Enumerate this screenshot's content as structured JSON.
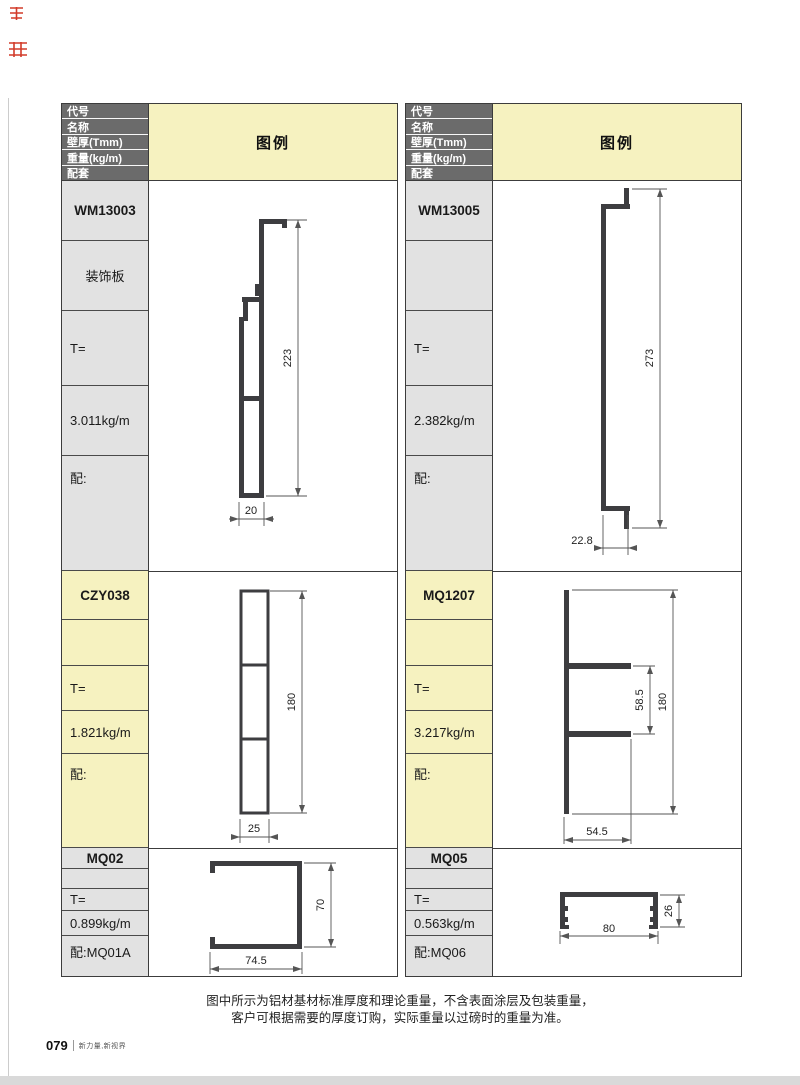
{
  "page": {
    "note_line1": "图中所示为铝材基材标准厚度和理论重量，不含表面涂层及包装重量，",
    "note_line2": "客户可根据需要的厚度订购，实际重量以过磅时的重量为准。",
    "footer_page": "079",
    "footer_brand": "新力量,新视界"
  },
  "header": {
    "rows": [
      "代号",
      "名称",
      "壁厚(Tmm)",
      "重量(kg/m)",
      "配套"
    ],
    "legend": "图例"
  },
  "colors": {
    "header_bg": "#6b6b6b",
    "yellow": "#f6f2c0",
    "gray": "#e2e2e2",
    "profile": "#3d3d40",
    "mark_red": "#d23b2a"
  },
  "left_table": {
    "sections": [
      {
        "code": "WM13003",
        "name": "装饰板",
        "thickness": "T=",
        "weight": "3.011kg/m",
        "match": "配:",
        "dims": {
          "height": "223",
          "width": "20"
        }
      },
      {
        "code": "CZY038",
        "name": "",
        "thickness": "T=",
        "weight": "1.821kg/m",
        "match": "配:",
        "dims": {
          "height": "180",
          "width": "25"
        }
      },
      {
        "code": "MQ02",
        "name": "",
        "thickness": "T=",
        "weight": "0.899kg/m",
        "match": "配:MQ01A",
        "dims": {
          "height": "70",
          "width": "74.5"
        }
      }
    ]
  },
  "right_table": {
    "sections": [
      {
        "code": "WM13005",
        "name": "",
        "thickness": "T=",
        "weight": "2.382kg/m",
        "match": "配:",
        "dims": {
          "height": "273",
          "width": "22.8"
        }
      },
      {
        "code": "MQ1207",
        "name": "",
        "thickness": "T=",
        "weight": "3.217kg/m",
        "match": "配:",
        "dims": {
          "height": "180",
          "width": "54.5",
          "inner": "58.5"
        }
      },
      {
        "code": "MQ05",
        "name": "",
        "thickness": "T=",
        "weight": "0.563kg/m",
        "match": "配:MQ06",
        "dims": {
          "height": "26",
          "width": "80"
        }
      }
    ]
  }
}
